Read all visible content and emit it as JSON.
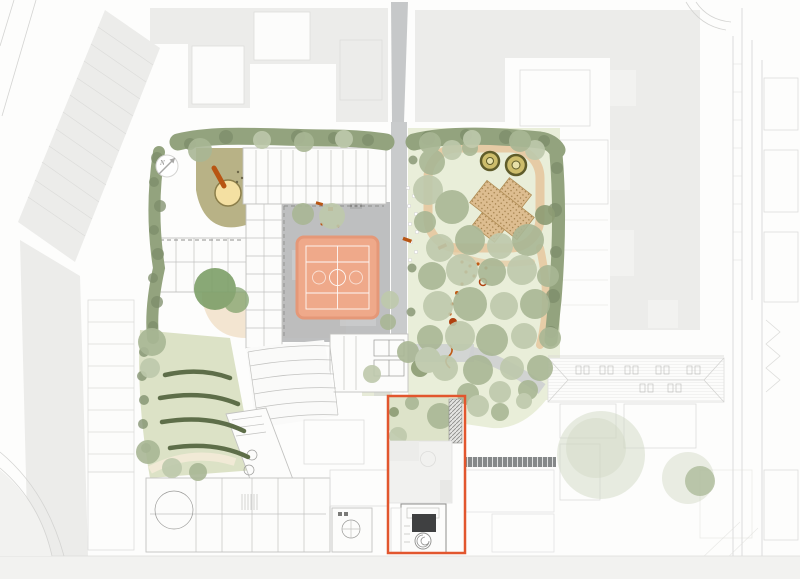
{
  "compass": {
    "label": "N"
  },
  "colors": {
    "page_bg": "#fdfdfc",
    "block_gray": "#ececea",
    "block_gray_light": "#f2f2f0",
    "block_outline": "#dddddb",
    "street_line": "#d4d4d2",
    "plot_line": "#dcdcda",
    "wall_line": "#9a9a98",
    "wall_line_light": "#c2c2c0",
    "dash_line": "#8f8f8d",
    "building_white": "#fcfcfb",
    "path_gray": "#c3c5c6",
    "path_gray_light": "#cfd1d2",
    "courtyard_gray": "#b8babb",
    "hedge_mid": "#93a37e",
    "hedge_dark": "#7d8d6a",
    "tree_sage": "#a9b795",
    "tree_sage_light": "#bec9ac",
    "tree_olive": "#8d9c74",
    "tree_deep": "#7d9f68",
    "tree_faded": "#cfd8c2",
    "lawn": "#e9eed9",
    "lawn_bright": "#dde3c9",
    "slope_lawn": "#dce2c6",
    "hedge_arc": "#5e6e49",
    "khaki": "#b4ae7f",
    "sand": "#f4e0a2",
    "sand_ring": "#8c7f4a",
    "terrace_tan": "#f3e5d1",
    "garden_path_tan": "#e6c79e",
    "allotment_tan": "#ddbd90",
    "allotment_dot": "#9c7a44",
    "ring_olive": "#5f5c2a",
    "ring_fill": "#cdbd6b",
    "court": "#efa98a",
    "court_border": "#e59878",
    "court_line": "#ffffff",
    "accent": "#e2562e",
    "equip_orange": "#b85513",
    "trail_orange": "#c05a14",
    "trail_red": "#b0400f",
    "canopy_dark": "#787b7c",
    "core_dark": "#3f4041",
    "cream_path": "#f1ead6"
  }
}
